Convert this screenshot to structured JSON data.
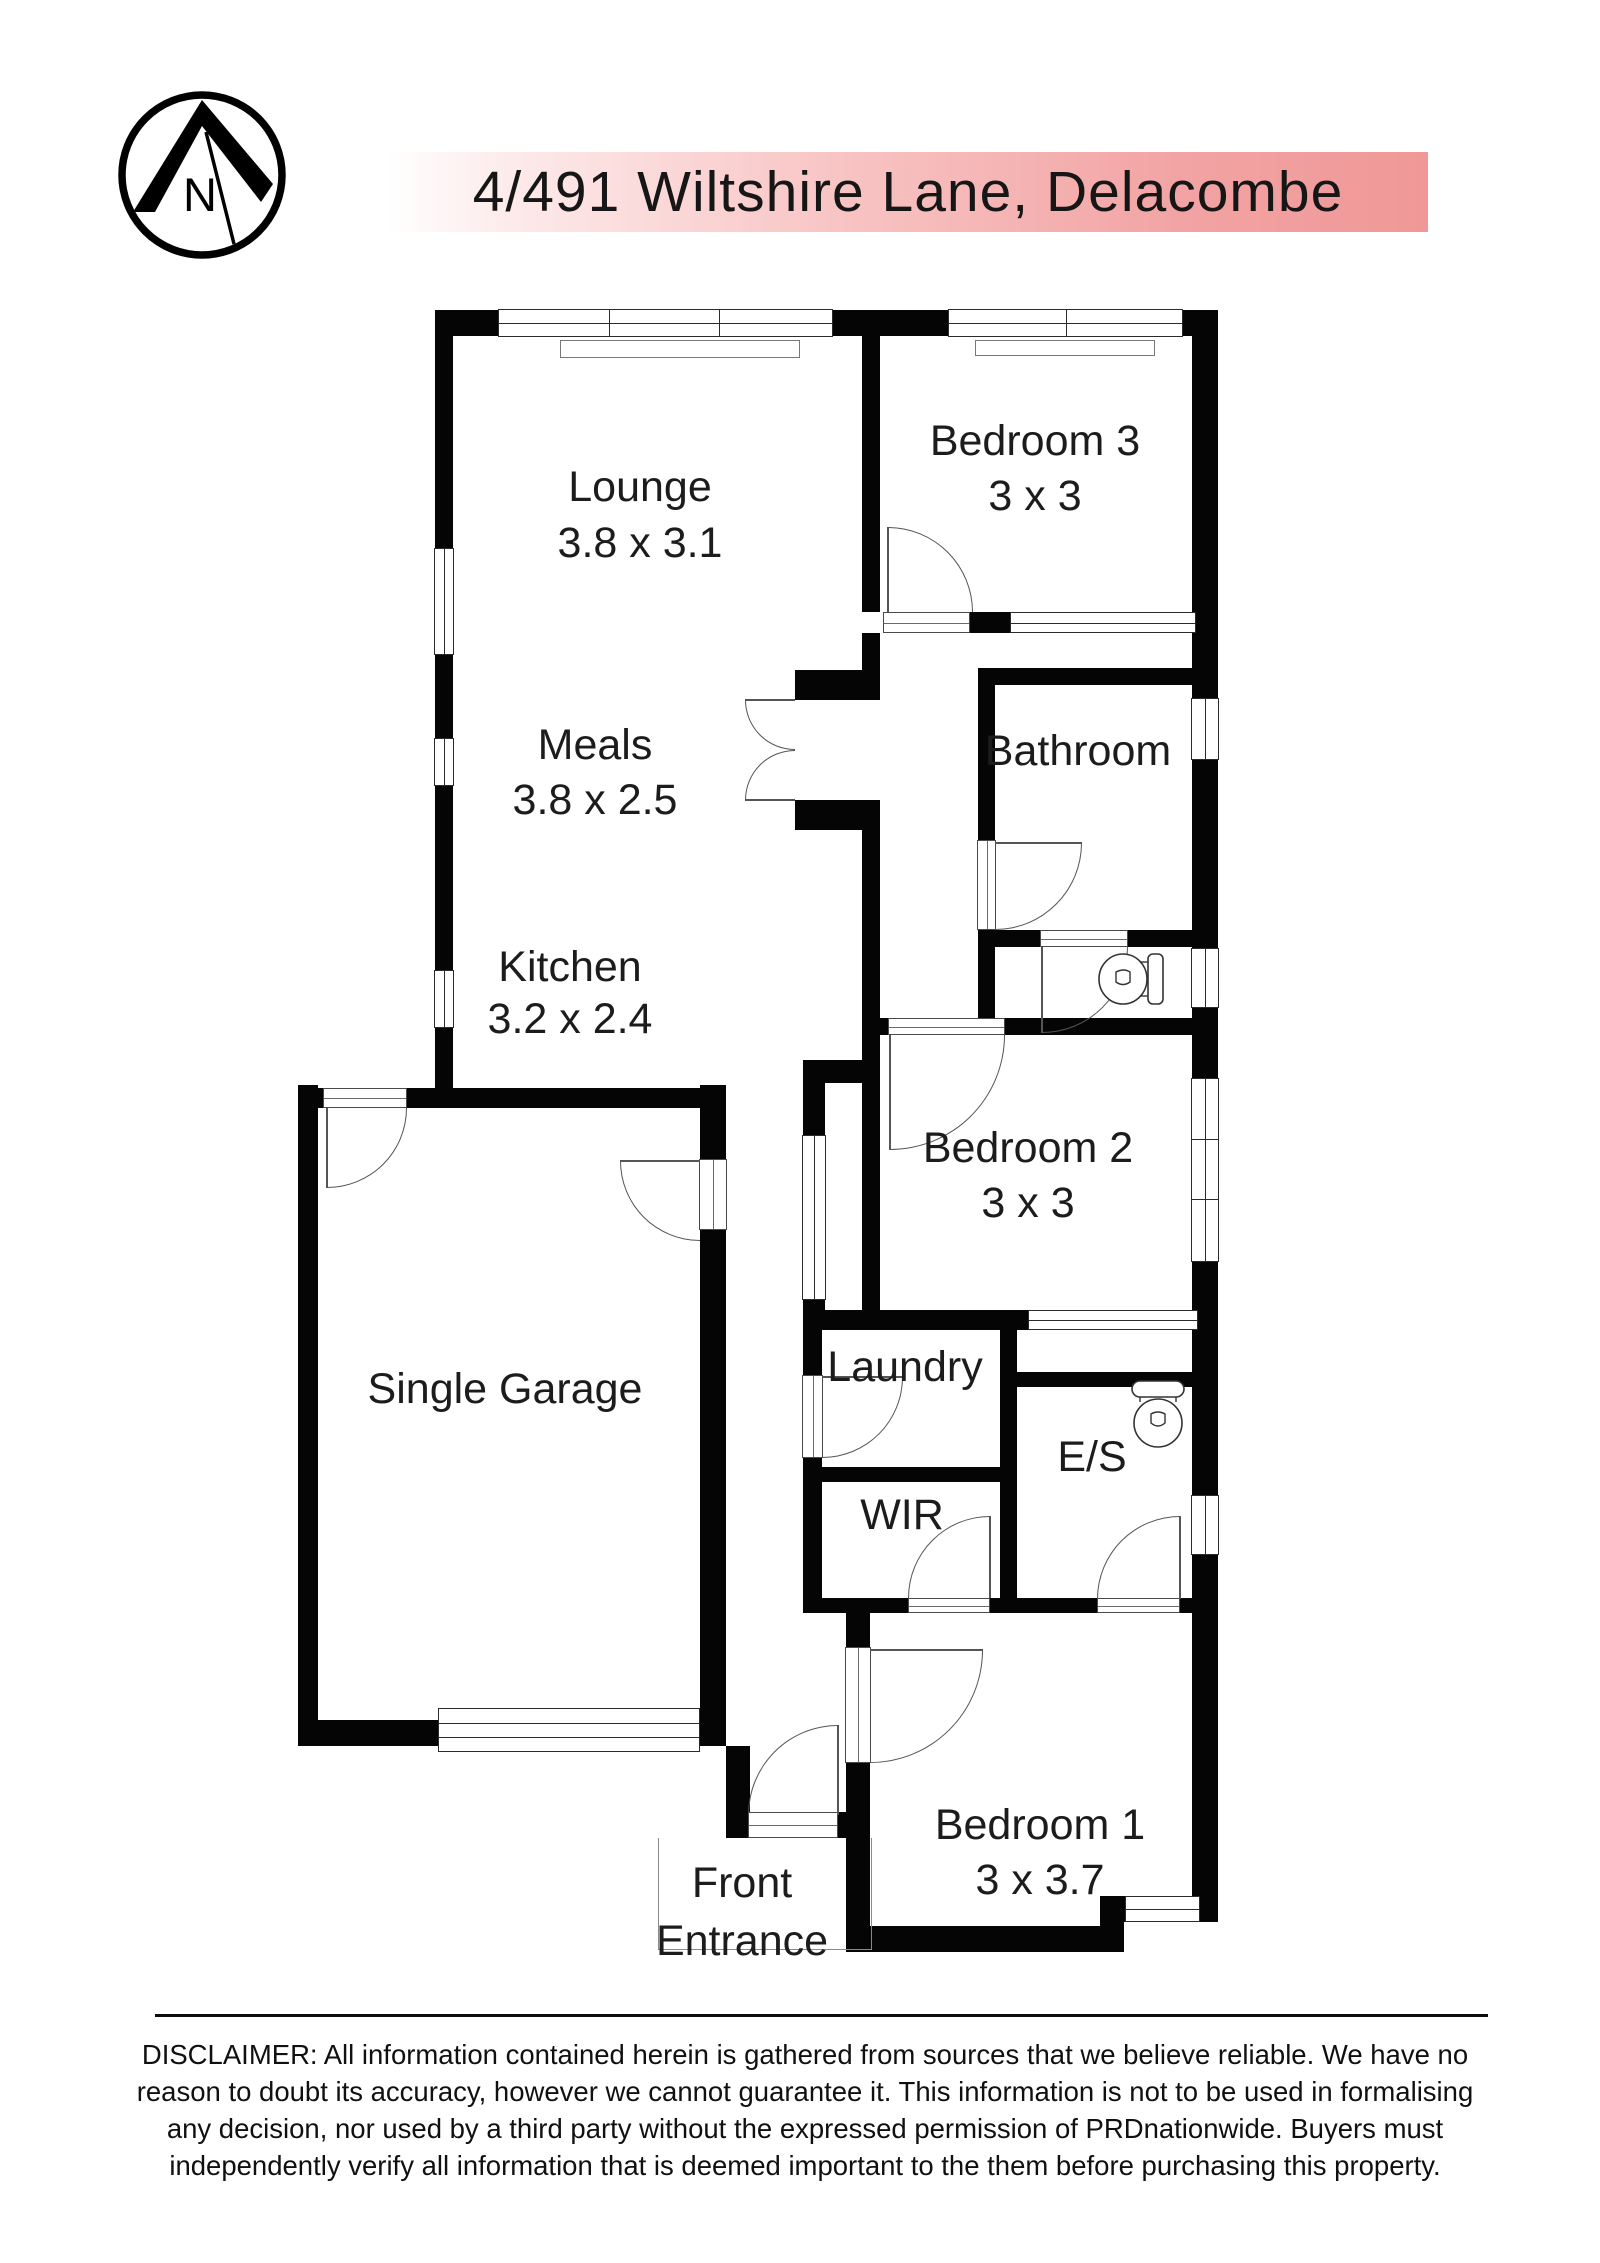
{
  "title": "4/491 Wiltshire Lane, Delacombe",
  "compass": {
    "letter": "N"
  },
  "rooms": {
    "lounge": {
      "name": "Lounge",
      "dims": "3.8 x 3.1"
    },
    "meals": {
      "name": "Meals",
      "dims": "3.8 x 2.5"
    },
    "kitchen": {
      "name": "Kitchen",
      "dims": "3.2 x 2.4"
    },
    "bedroom3": {
      "name": "Bedroom 3",
      "dims": "3 x 3"
    },
    "bathroom": {
      "name": "Bathroom",
      "dims": ""
    },
    "bedroom2": {
      "name": "Bedroom 2",
      "dims": "3 x 3"
    },
    "laundry": {
      "name": "Laundry",
      "dims": ""
    },
    "ensuite": {
      "name": "E/S",
      "dims": ""
    },
    "wir": {
      "name": "WIR",
      "dims": ""
    },
    "garage": {
      "name": "Single Garage",
      "dims": ""
    },
    "bedroom1": {
      "name": "Bedroom 1",
      "dims": "3 x 3.7"
    },
    "entrance": {
      "line1": "Front",
      "line2": "Entrance"
    }
  },
  "disclaimer": {
    "lines": [
      "DISCLAIMER: All information contained herein is gathered from sources that we believe reliable. We have no",
      "reason to doubt its accuracy, however we cannot guarantee it. This information is not to be used in formalising",
      "any decision, nor used by a third party without the expressed permission of PRDnationwide. Buyers must",
      "independently verify all information that is deemed important to the them before purchasing this property."
    ]
  },
  "colors": {
    "wall": "#050505",
    "accent_start": "#ffffff",
    "accent_end": "#f09898",
    "thin_line": "#555555"
  }
}
